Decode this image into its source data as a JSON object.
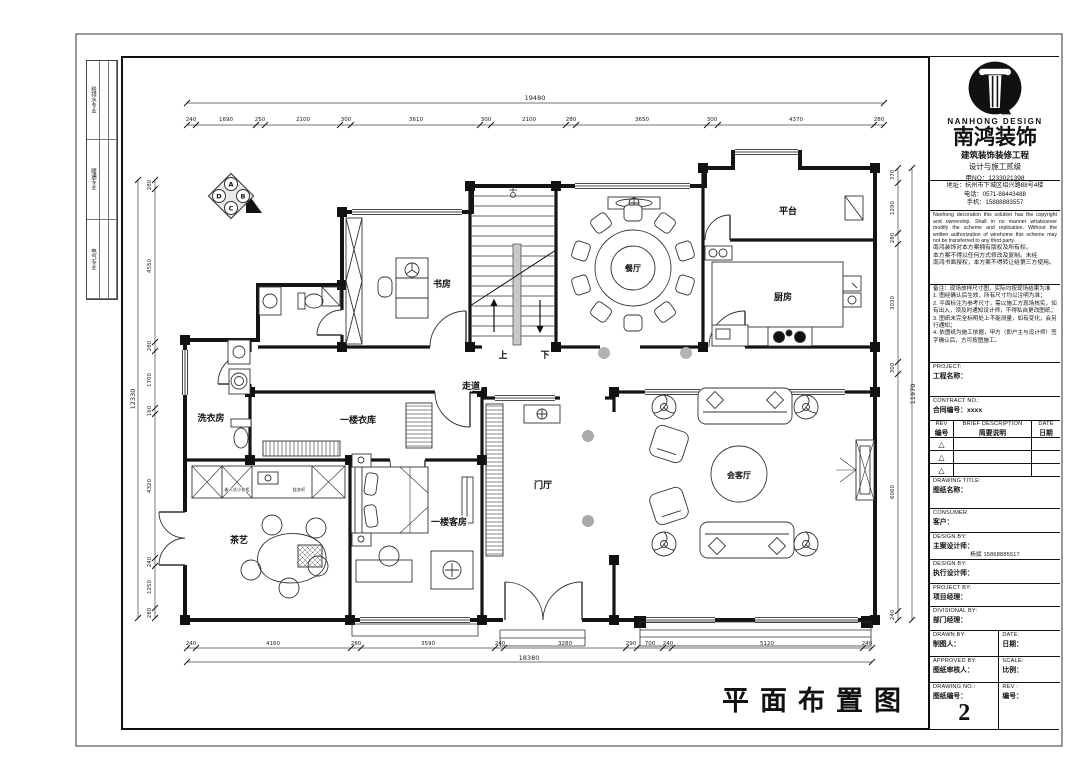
{
  "footer": {
    "title": "平面布置图"
  },
  "left_strip": {
    "items": [
      "给排水专业",
      "暖通专业",
      "电气专业"
    ]
  },
  "plan": {
    "rooms": {
      "study": "书房",
      "dining": "餐厅",
      "kitchen": "厨房",
      "platform": "平台",
      "corridor": "走道",
      "laundry": "洗衣房",
      "cloakroom": "一楼衣库",
      "tea": "茶艺",
      "guest": "一楼客房",
      "foyer": "门厅",
      "living": "会客厅"
    },
    "stair_up": "上",
    "stair_down": "下",
    "small_labels": {
      "closet": "嵌入式小衣柜",
      "rod": "挂衣杆"
    },
    "direction_letters": [
      "A",
      "B",
      "C",
      "D"
    ]
  },
  "dims": {
    "top_total": "19480",
    "top": [
      "240",
      "1690",
      "250",
      "2100",
      "300",
      "3610",
      "300",
      "2100",
      "280",
      "3650",
      "300",
      "4370",
      "280"
    ],
    "bottom_total": "18380",
    "bottom": [
      "240",
      "4160",
      "280",
      "3590",
      "240",
      "3280",
      "290",
      "700",
      "240",
      "5120",
      "240"
    ],
    "left_total": "12330",
    "left": [
      "280",
      "4550",
      "280",
      "1700",
      "160",
      "4320",
      "240",
      "1250",
      "280"
    ],
    "right_total": "11970",
    "right": [
      "370",
      "1290",
      "280",
      "3030",
      "300",
      "6060",
      "240"
    ]
  },
  "title_block": {
    "logo_en": "NANHONG DESIGN",
    "company": "南鸿装饰",
    "line1": "建筑装饰装修工程",
    "line2": "设计与施工贰级",
    "line3": "甲NO：1233021398",
    "address": "地址：杭州市下城区绍兴路88号4楼",
    "tel": "电话：0571-88443488",
    "mobile": "手机：15888883557",
    "copyright_en": "Nanhong decoration this solution has the copyright and ownership. Shall in no manner whatsoever modify the scheme and replication. Without the written authorization of wirehome this scheme may not be transferred to any third party.",
    "copyright_cn1": "南鸿装饰对本方案拥有版权及所有权。",
    "copyright_cn2": "本方案不得以任何方式修改及复制。未经",
    "copyright_cn3": "南鸿书面授权，本方案不得转让给第三方使用。",
    "notes_title": "备注：现场放样尺寸图，实际均按现场结果为准",
    "note1": "1. 图经确认后生效，所有尺寸均以注明为准；",
    "note2": "2. 平面标注为参考尺寸，需以施工方现场核实，如有出入，须及时通知设计师，不得私自更改图纸；",
    "note3": "3. 图纸未完全标明处上不能测量，如有变化，会另行通知；",
    "note4": "4. 依图纸为施工依据，甲方（即户主与设计师）签字确认后，方可按图施工。",
    "fields": {
      "project_en": "PROJECT:",
      "project_cn": "工程名称：",
      "contract_en": "CONTRACT NO.:",
      "contract_cn": "合同编号：xxxx",
      "rev_en": "REV",
      "rev_cn": "编号",
      "desc_en": "BRIEF DESCRIPTION",
      "desc_cn": "简要说明",
      "date_en": "DATE",
      "date_cn": "日期",
      "rev_mark": "△",
      "drawing_title_en": "DRAWING TITLE:",
      "drawing_title_cn": "图纸名称：",
      "consumer_en": "CONSUMER",
      "consumer_cn": "客户：",
      "design_by_en": "DESIGN BY:",
      "design_by_cn": "主案设计师：",
      "design_by_value": "杨斌 15868885517",
      "design_by2_en": "DESIGN BY:",
      "design_by2_cn": "执行设计师：",
      "project_by_en": "PROJECT BY:",
      "project_by_cn": "项目经理：",
      "divisional_by_en": "DIVISIONAL BY:",
      "divisional_by_cn": "部门经理：",
      "drawn_by_en": "DRAWN BY:",
      "drawn_by_cn": "制图人：",
      "date2_en": "DATE:",
      "date2_cn": "日期：",
      "approved_by_en": "APPROVED BY:",
      "approved_by_cn": "图纸审核人：",
      "scale_en": "SCALE:",
      "scale_cn": "比例：",
      "drawing_no_en": "DRAWING NO.:",
      "drawing_no_cn": "图纸编号：",
      "drawing_no_value": "2",
      "rev2_en": "REV :",
      "rev2_cn": "编号："
    }
  }
}
